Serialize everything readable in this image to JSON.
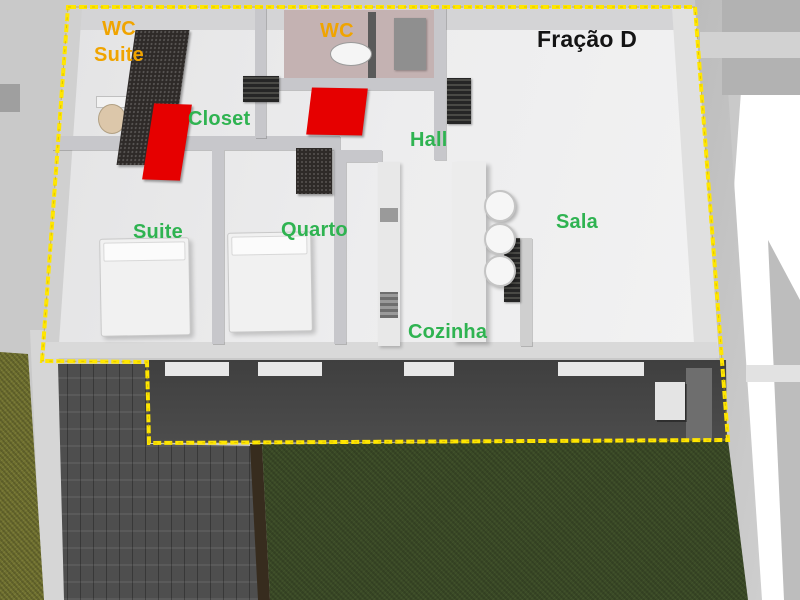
{
  "floorplan": {
    "unit_label": "Fração D",
    "rooms": [
      {
        "id": "wc-suite",
        "label": "WC Suite",
        "label_lines": [
          "WC",
          "Suite"
        ],
        "label_color": "#f0a400"
      },
      {
        "id": "wc",
        "label": "WC",
        "label_color": "#f0a400"
      },
      {
        "id": "closet",
        "label": "Closet",
        "label_color": "#2fb351"
      },
      {
        "id": "hall",
        "label": "Hall",
        "label_color": "#2fb351"
      },
      {
        "id": "suite",
        "label": "Suite",
        "label_color": "#2fb351"
      },
      {
        "id": "quarto",
        "label": "Quarto",
        "label_color": "#2fb351"
      },
      {
        "id": "sala",
        "label": "Sala",
        "label_color": "#2fb351"
      },
      {
        "id": "cozinha",
        "label": "Cozinha",
        "label_color": "#2fb351"
      }
    ],
    "colors": {
      "boundary_dashed_line": "#ffe600",
      "highlight_elements": "#e60000",
      "room_label_green": "#2fb351",
      "wc_label_orange": "#f0a400",
      "unit_label_black": "#141414",
      "lawn_green": "#3b4a27",
      "driveway_gray": "#4e4e4e",
      "terrace_gray": "#454545",
      "walls_light_gray": "#e9e9ea",
      "wc_floor_pink": "#c4b2b2"
    }
  }
}
